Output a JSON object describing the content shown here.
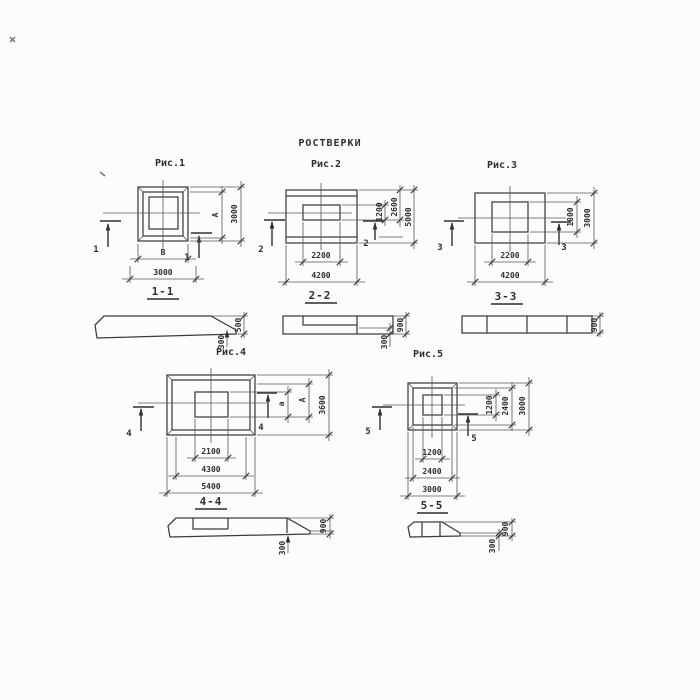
{
  "title": "РОСТВЕРКИ",
  "colors": {
    "ink": "#3a3a3a",
    "paper": "#fcfcfc"
  },
  "figures": [
    {
      "caption": "Рис.1",
      "cut": "1",
      "section": "1-1",
      "dims": {
        "inner_width": "В",
        "outer_width": "3000",
        "inner_height": "А",
        "outer_height": "3000"
      }
    },
    {
      "caption": "Рис.2",
      "cut": "2",
      "section": "2-2",
      "dims": {
        "inner_width": "2200",
        "outer_width": "4200",
        "inner_height": "1200",
        "mid_height": "2600",
        "outer_height": "5000"
      }
    },
    {
      "caption": "Рис.3",
      "cut": "3",
      "section": "3-3",
      "dims": {
        "inner_width": "2200",
        "outer_width": "4200",
        "inner_height": "1800",
        "outer_height": "3000"
      }
    },
    {
      "caption": "Рис.4",
      "cut": "4",
      "section": "4-4",
      "dims": {
        "inner_width": "2100",
        "mid_width": "4300",
        "outer_width": "5400",
        "inner_height": "а",
        "mid_height": "А",
        "outer_height": "3600"
      }
    },
    {
      "caption": "Рис.5",
      "cut": "5",
      "section": "5-5",
      "dims": {
        "inner_width": "1200",
        "mid_width": "2400",
        "outer_width": "3000",
        "inner_height": "1200",
        "mid_height": "2400",
        "outer_height": "3000"
      }
    }
  ],
  "sections": [
    {
      "name": "1-1",
      "thickness": "500",
      "edge": "300"
    },
    {
      "name": "2-2",
      "thickness": "900",
      "edge": "300"
    },
    {
      "name": "3-3",
      "thickness": "900"
    },
    {
      "name": "4-4",
      "thickness": "900",
      "edge": "300"
    },
    {
      "name": "5-5",
      "thickness": "900",
      "edge": "300"
    }
  ]
}
